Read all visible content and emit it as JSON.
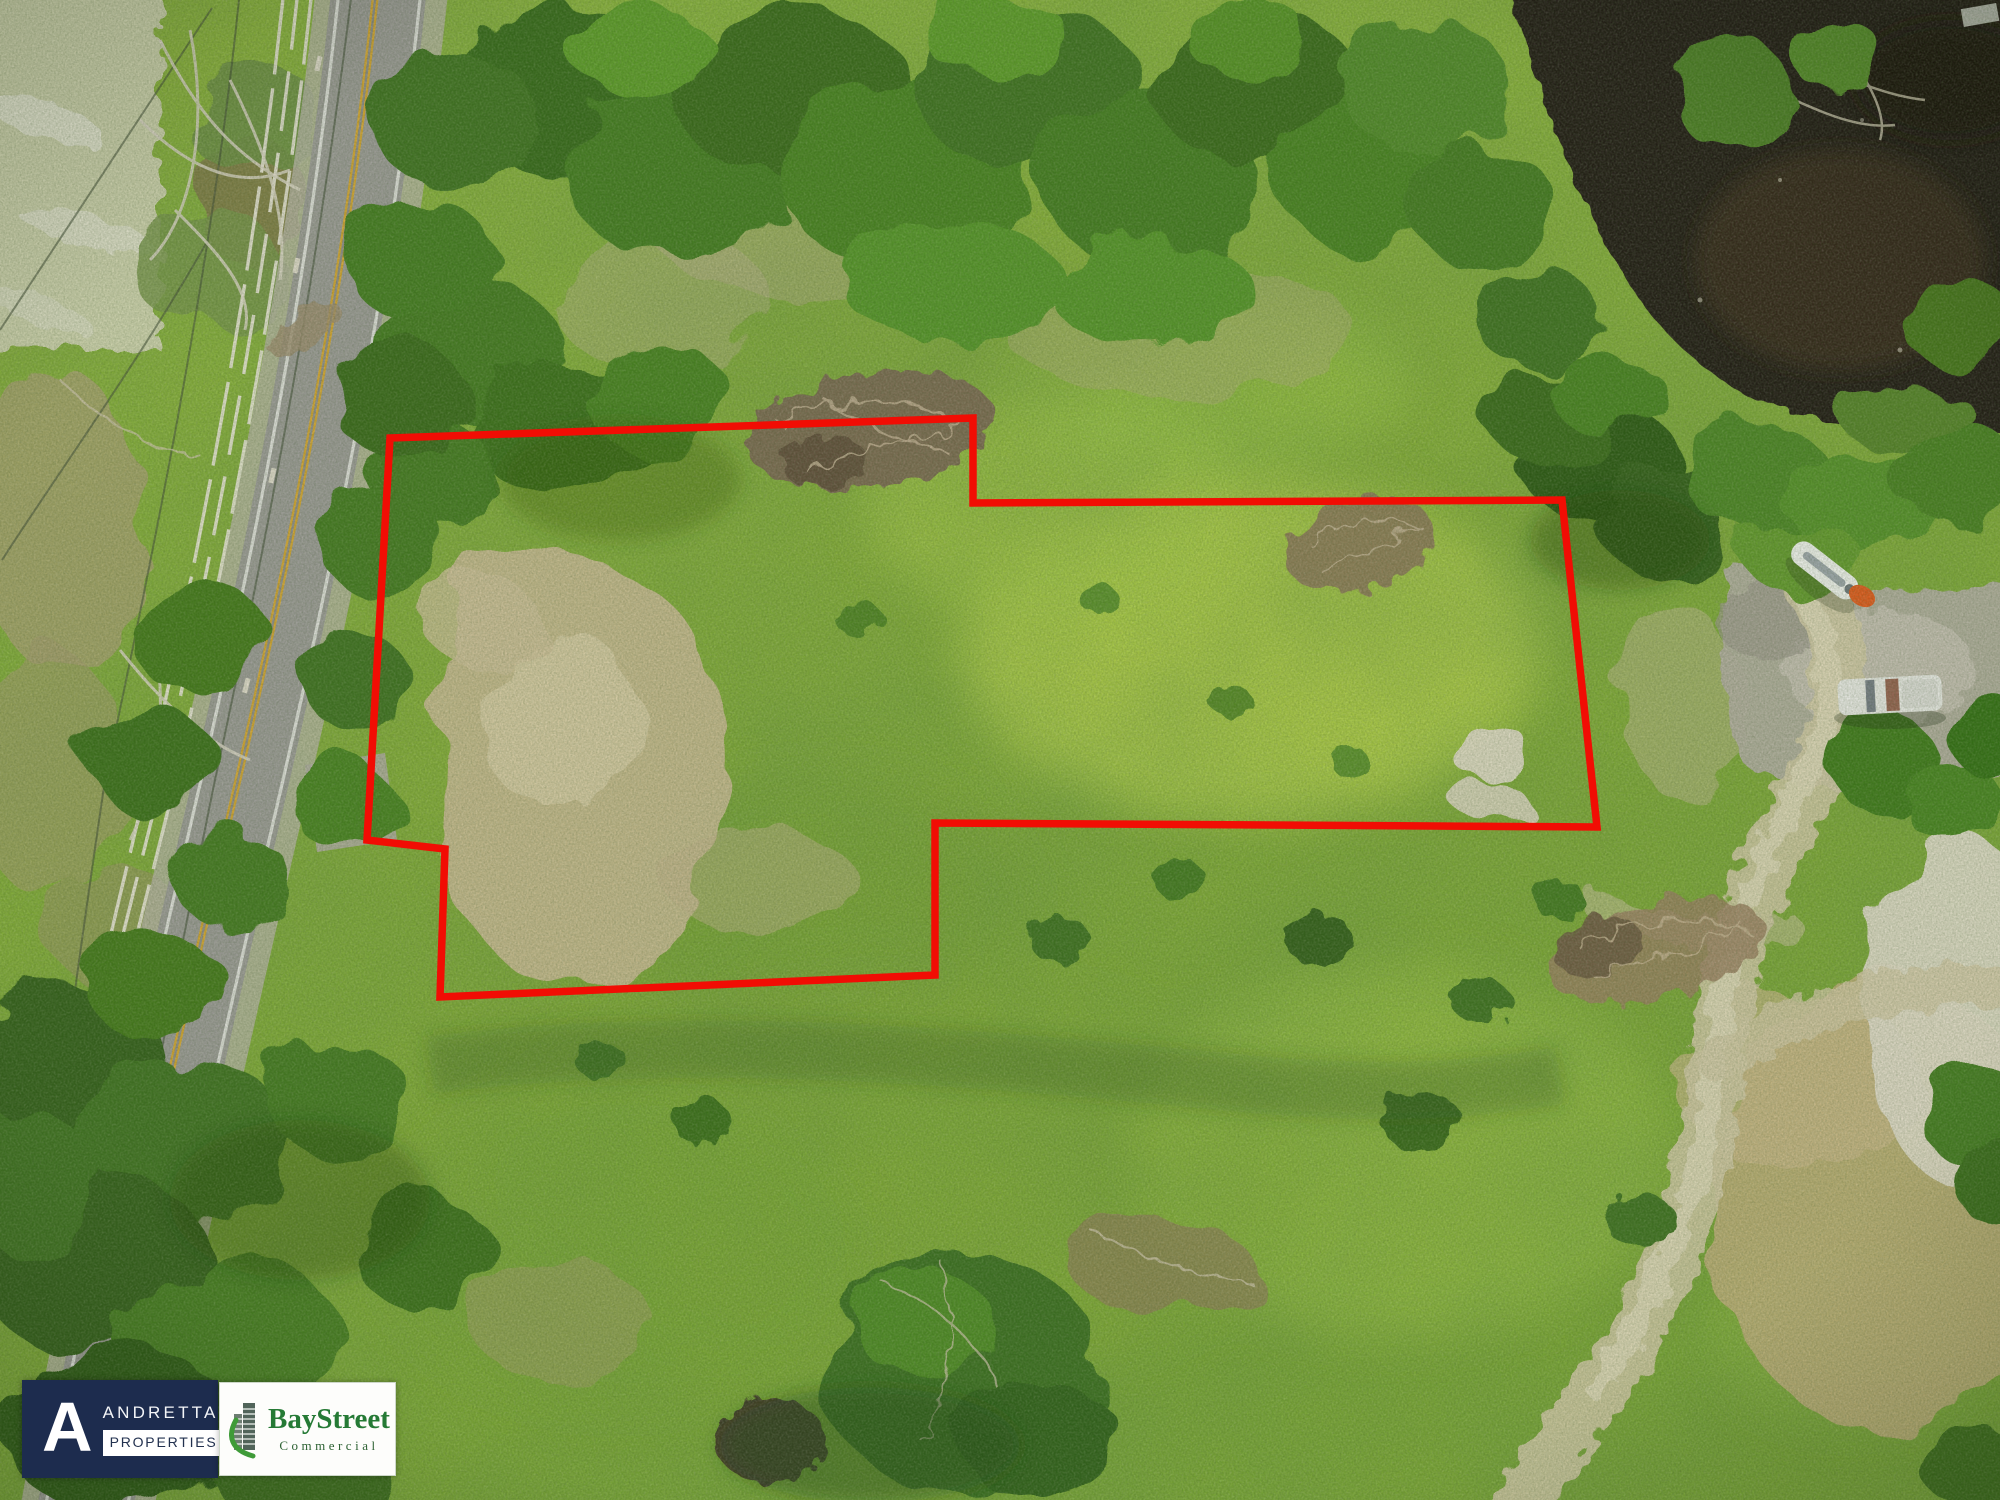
{
  "overlay": {
    "parcel_boundary": {
      "points": "390,438 973,418 973,503 1562,500 1597,827 935,823 935,975 440,997 445,849 367,840",
      "color": "#f10d04",
      "stroke_width": 7.5
    }
  },
  "branding": {
    "andretta": {
      "monogram": "A",
      "name": "ANDRETTA",
      "division": "PROPERTIES",
      "panel_color": "#1d2c4e",
      "text_color": "#ffffff"
    },
    "baystreet": {
      "name": "BayStreet",
      "division": "Commercial",
      "text_color": "#257a35",
      "panel_color": "#fdfdfb",
      "swoosh_color": "#3f9b38"
    }
  },
  "scene_palette": {
    "meadow_green": "#85ad3b",
    "canopy_green": "#3c6f1e",
    "vivid_grass": "#b7d14e",
    "bare_sand": "#c8b992",
    "pond_water": "#241e15",
    "asphalt": "#9a9995",
    "center_line_yellow": "#d2a433",
    "dirt_trail": "#cfc6a4"
  }
}
